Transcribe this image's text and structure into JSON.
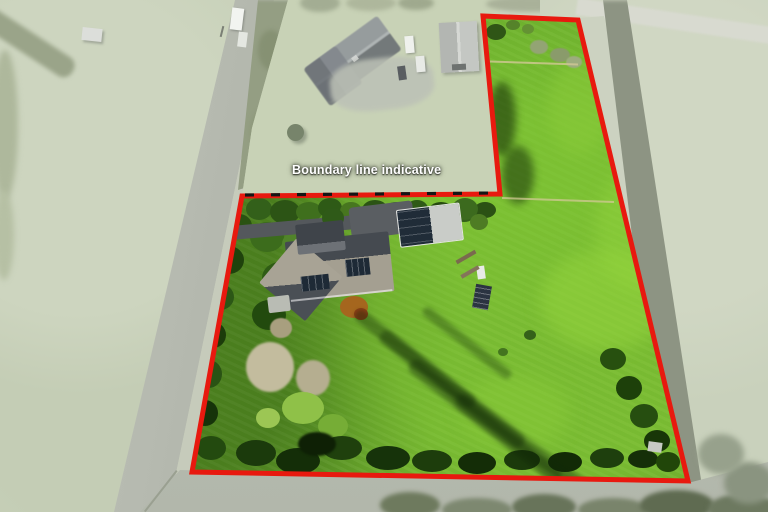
{
  "scene": {
    "type": "aerial property photograph",
    "description": "Rural lifestyle property outlined in red; surroundings shown faded"
  },
  "overlay": {
    "label": "Boundary line indicative",
    "boundary_color": "#e8190f",
    "dash_color": "#141414",
    "label_color": "#ffffff"
  },
  "palette": {
    "inside_grass": "#6aa92c",
    "bright_lawn": "#7ec636",
    "outside_faded": "#ccd4c0",
    "road": "#b7bbb1",
    "tree_dark": "#2a5212",
    "house_roof_light": "#a39e90",
    "house_roof_dark": "#42474d",
    "solar_panel": "#1e2a36",
    "shadow_band": "#8d9483"
  }
}
